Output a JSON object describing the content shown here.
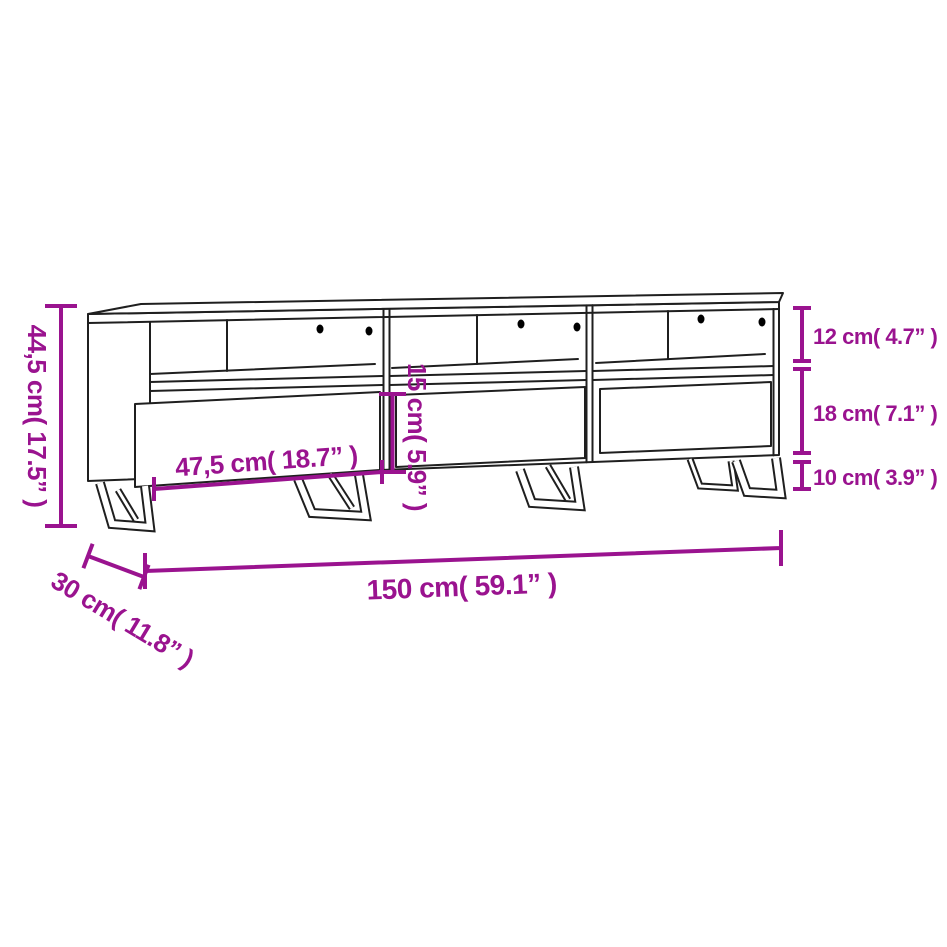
{
  "figure": {
    "kind": "furniture-dimension-diagram",
    "colors": {
      "dimension_accent": "#9A138F",
      "drawing_line": "#1F1F1F",
      "background": "#FFFFFF",
      "cable_hole": "#000000"
    },
    "labels": {
      "total_height": "44,5 cm( 17.5” )",
      "total_width": "150 cm( 59.1” )",
      "depth": "30 cm( 11.8” )",
      "inner_width": "47,5 cm( 18.7” )",
      "inner_height": "15 cm( 5.9” )",
      "top_compartment_height": "12 cm( 4.7” )",
      "drawer_height": "18 cm( 7.1” )",
      "leg_height": "10 cm( 3.9” )"
    }
  }
}
